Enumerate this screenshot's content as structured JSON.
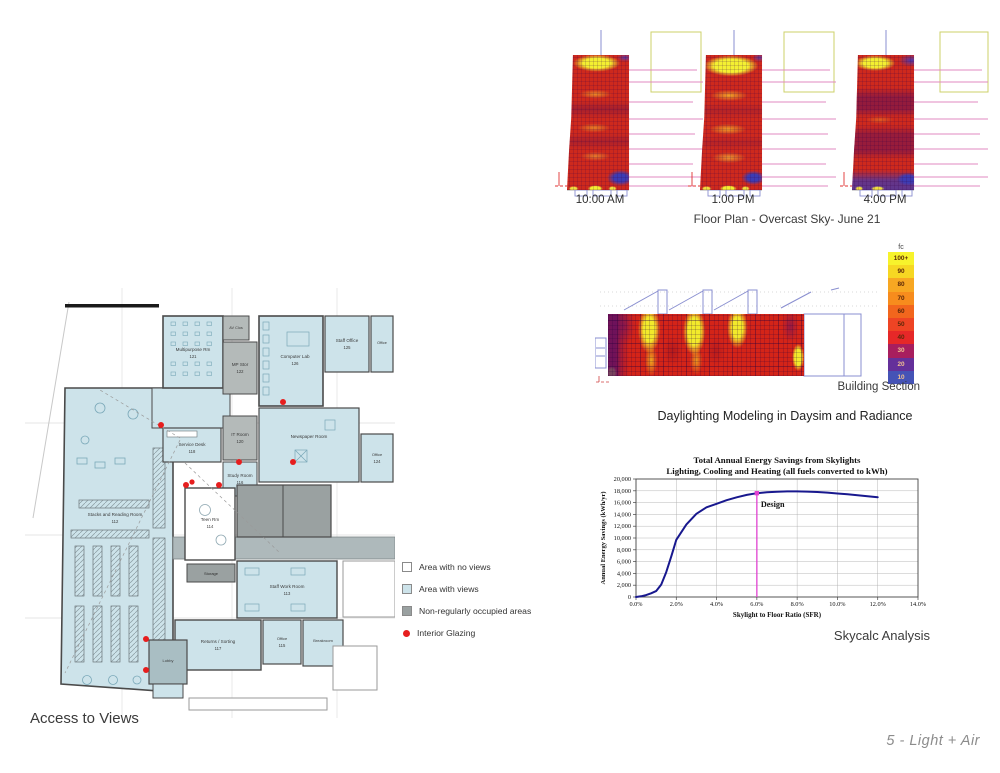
{
  "page": {
    "footer": "5  - Light + Air"
  },
  "access_views": {
    "caption": "Access to Views",
    "legend": [
      {
        "label": "Area with no views",
        "swatch": "square",
        "color": "#ffffff"
      },
      {
        "label": "Area with views",
        "swatch": "square",
        "color": "#cde3ea"
      },
      {
        "label": "Non-regularly occupied areas",
        "swatch": "square",
        "color": "#9aa1a1"
      },
      {
        "label": "Interior Glazing",
        "swatch": "dot",
        "color": "#e61e1e"
      }
    ],
    "rooms": [
      {
        "label": "Stacks and Reading Room",
        "num": "112"
      },
      {
        "label": "Multipurpose Rm",
        "num": "121"
      },
      {
        "label": "AV Clos",
        "num": ""
      },
      {
        "label": "MP Stor",
        "num": "122"
      },
      {
        "label": "IT Room",
        "num": "120"
      },
      {
        "label": "Study Room",
        "num": "116"
      },
      {
        "label": "Service Desk",
        "num": "118"
      },
      {
        "label": "Computer Lab",
        "num": "126"
      },
      {
        "label": "Staff Office",
        "num": "125"
      },
      {
        "label": "Office",
        "num": ""
      },
      {
        "label": "Newspaper Room",
        "num": ""
      },
      {
        "label": "Office",
        "num": "124"
      },
      {
        "label": "Teen Rm",
        "num": "114"
      },
      {
        "label": "Storage",
        "num": ""
      },
      {
        "label": "Staff Work Room",
        "num": "113"
      },
      {
        "label": "Returns / Sorting",
        "num": "117"
      },
      {
        "label": "Office",
        "num": "115"
      },
      {
        "label": "Breakroom",
        "num": ""
      },
      {
        "label": "Lobby",
        "num": ""
      }
    ]
  },
  "daylight_plans": {
    "caption": "Floor Plan - Overcast Sky- June  21",
    "times": [
      "10:00 AM",
      "1:00 PM",
      "4:00 PM"
    ]
  },
  "building_section": {
    "caption": "Building Section",
    "subtitle": "Daylighting Modeling in Daysim and Radiance",
    "legend_title": "fc",
    "legend": [
      {
        "label": "100+",
        "color": "#f7f32c"
      },
      {
        "label": "90",
        "color": "#f6d723"
      },
      {
        "label": "80",
        "color": "#f7a722"
      },
      {
        "label": "70",
        "color": "#f78c1d"
      },
      {
        "label": "60",
        "color": "#f2661d"
      },
      {
        "label": "50",
        "color": "#ee4424"
      },
      {
        "label": "40",
        "color": "#e62828"
      },
      {
        "label": "30",
        "color": "#a81e5e"
      },
      {
        "label": "20",
        "color": "#64309a"
      },
      {
        "label": "10",
        "color": "#4553b6"
      }
    ]
  },
  "skycalc": {
    "caption": "Skycalc Analysis"
  },
  "chart_data": {
    "type": "line",
    "title": "Total Annual Energy Savings from Skylights",
    "subtitle": "Lighting, Cooling and Heating (all fuels converted to kWh)",
    "xlabel": "Skylight to Floor Ratio (SFR)",
    "ylabel": "Annual Energy Savings (kWh/yr)",
    "xlim": [
      0,
      14
    ],
    "ylim": [
      0,
      20000
    ],
    "grid": true,
    "xticklabels": [
      "0.0%",
      "2.0%",
      "4.0%",
      "6.0%",
      "8.0%",
      "10.0%",
      "12.0%",
      "14.0%"
    ],
    "yticklabels": [
      "0",
      "2,000",
      "4,000",
      "6,000",
      "8,000",
      "10,000",
      "12,000",
      "14,000",
      "16,000",
      "18,000",
      "20,000"
    ],
    "series": [
      {
        "name": "Total annual energy savings",
        "color": "#18188e",
        "x": [
          0,
          0.25,
          0.5,
          0.75,
          1,
          1.25,
          1.5,
          1.75,
          2,
          2.5,
          3,
          3.5,
          4,
          4.5,
          5,
          5.5,
          6,
          6.5,
          7,
          7.5,
          8,
          8.5,
          9,
          9.5,
          10,
          10.5,
          11,
          11.5,
          12
        ],
        "y": [
          0,
          120,
          320,
          620,
          1000,
          2100,
          4200,
          6900,
          9700,
          12300,
          14100,
          15200,
          15800,
          16400,
          16900,
          17300,
          17600,
          17750,
          17850,
          17900,
          17900,
          17870,
          17800,
          17700,
          17550,
          17400,
          17250,
          17080,
          16900
        ]
      }
    ],
    "annotations": [
      {
        "label": "Design",
        "x": 6.0,
        "y": 17600,
        "color": "#e040d0"
      }
    ]
  }
}
